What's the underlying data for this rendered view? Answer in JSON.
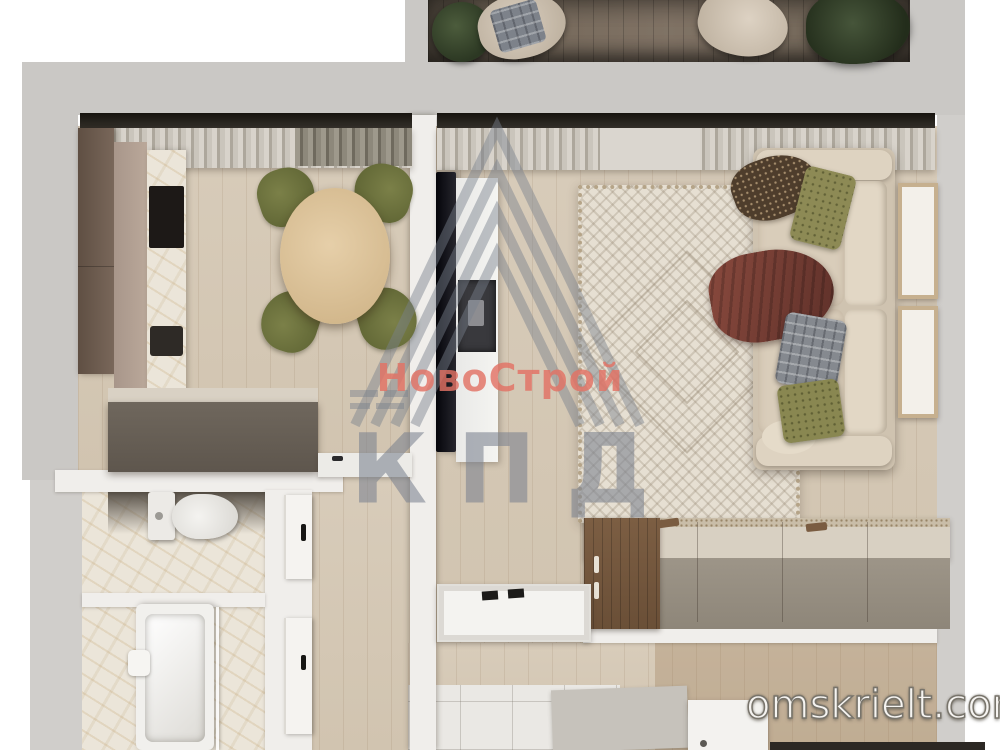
{
  "meta": {
    "type": "apartment-floorplan-3d-render",
    "view": "top-down",
    "width_px": 1000,
    "height_px": 750
  },
  "watermark": {
    "brand_top": "НовоСтрой",
    "brand_bottom": "КПД",
    "brand_top_color": "#e27164",
    "brand_bottom_color": "#7a828f"
  },
  "site_watermark": {
    "text": "omskrielt.com",
    "color": "#f6f4f1"
  },
  "palette": {
    "background": "#ffffff",
    "outer_wall": "#cac8c5",
    "inner_wall": "#f0eeeb",
    "floor_wood": "#d6cab8",
    "balcony_floor": "#7b6f60",
    "cabinet_dark_brown": "#6d5b4e",
    "cabinet_beige": "#b3a092",
    "island_front": "#6f675d",
    "counter_marble": "#ebe5d9",
    "dining_table_wood": "#ddc49e",
    "chair_olive": "#6f7342",
    "sofa_beige": "#d6cbb8",
    "rug_cream": "#e6dfd2",
    "sideboard_front": "#99917f",
    "sideboard_wood_end": "#77593f",
    "plant_green": "#39462f",
    "tile_floor": "#eae8e4"
  },
  "scene": {
    "balcony": {
      "items": [
        "potted-plant",
        "lounge-chair",
        "plaid-cushion",
        "lounge-chair",
        "shrub"
      ]
    },
    "kitchen": {
      "items": [
        "tall-cabinet",
        "base-cabinets",
        "marble-counter",
        "cooktop",
        "oven",
        "island",
        "white-counter",
        "dining-table",
        "flower-bouquet",
        "chair",
        "chair",
        "chair",
        "chair",
        "curtains"
      ]
    },
    "living_room": {
      "items": [
        "curtains",
        "tv",
        "media-console",
        "area-rug",
        "sofa",
        "pillow-houndstooth",
        "pillow-olive",
        "throw-blanket",
        "pillow-plaid",
        "pillow-olive",
        "artwork-frame",
        "artwork-frame",
        "sideboard"
      ]
    },
    "wc": {
      "items": [
        "toilet"
      ]
    },
    "bathroom": {
      "items": [
        "bathtub",
        "shower-area"
      ]
    },
    "hallway": {
      "items": [
        "door",
        "door",
        "shoe-tray",
        "floor-mat",
        "cabinet",
        "entry-mat"
      ]
    }
  }
}
